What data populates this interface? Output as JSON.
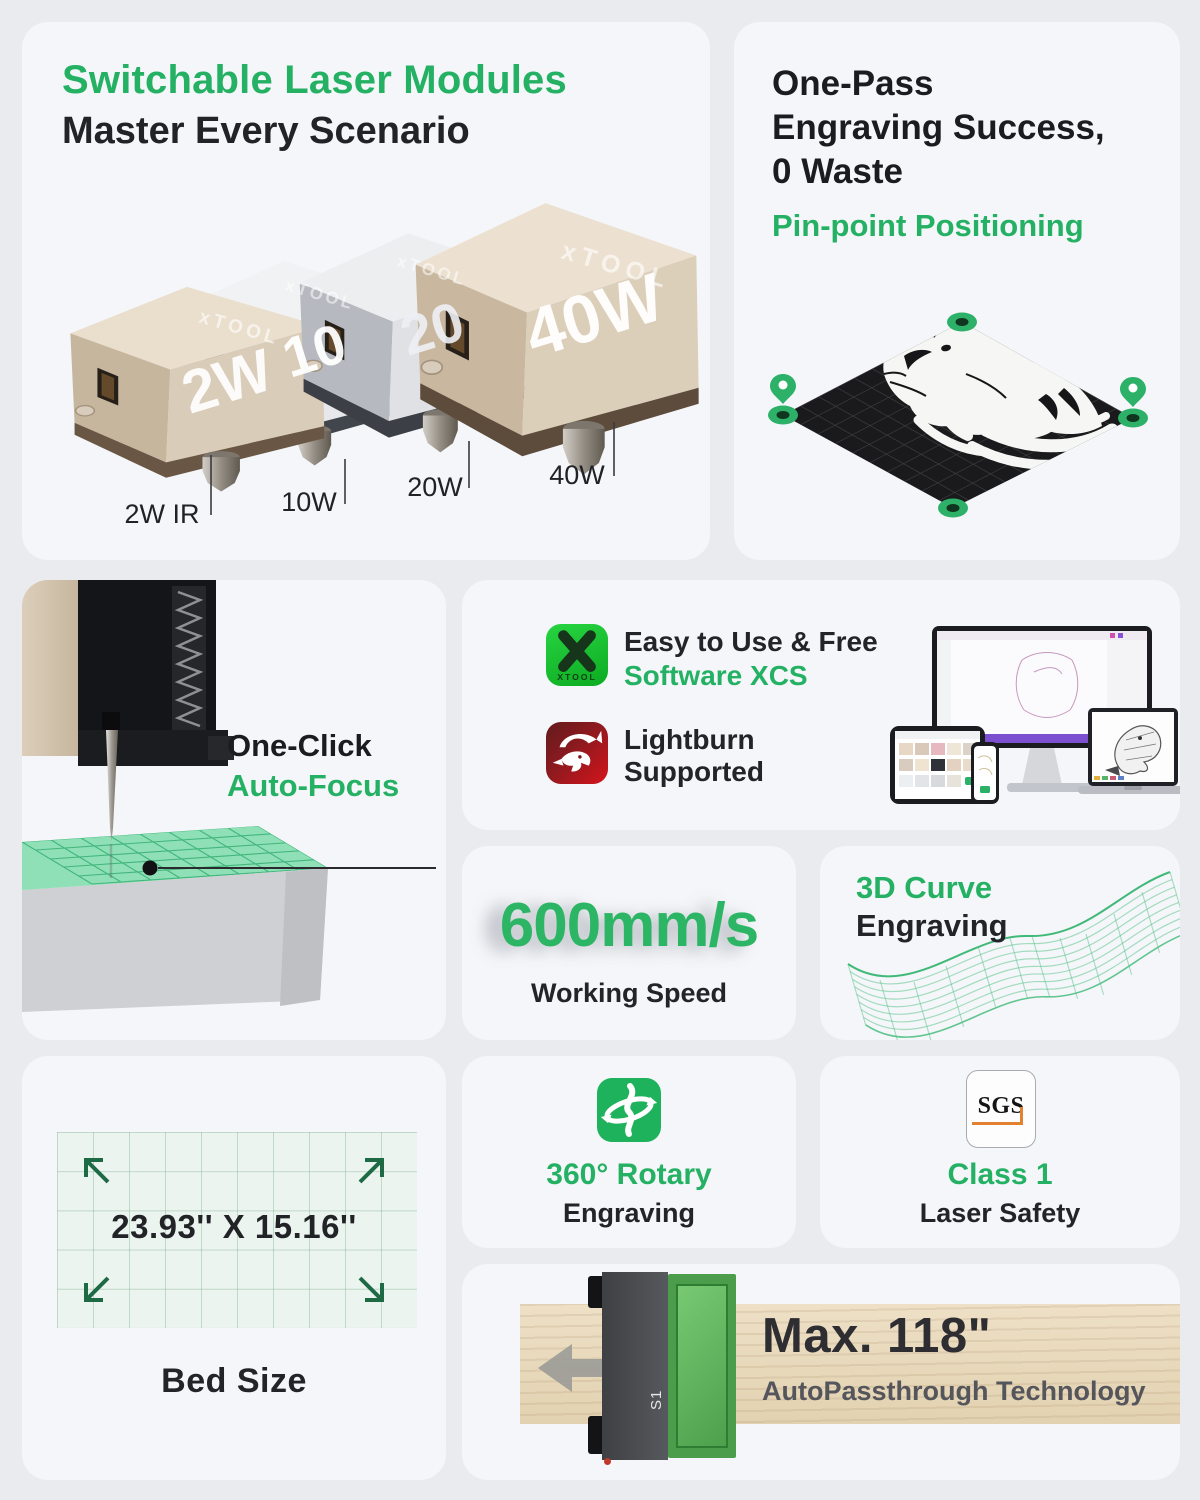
{
  "colors": {
    "page_bg": "#e9ebee",
    "card_bg": "#f4f6f9",
    "accent_green": "#25b164",
    "dark_text": "#1b1c20",
    "xcs_icon_green": "#16c12e",
    "lightburn_red": "#a5161f",
    "machine_green": "#4c9d4b",
    "wood": "#e2d2b1",
    "bed_grid_green": "#ebf4ee",
    "sgs_orange": "#e2812f"
  },
  "brand": "xTOOL",
  "cards": {
    "modules": {
      "title": "Switchable Laser Modules",
      "subtitle": "Master Every Scenario",
      "face_labels": [
        "2W",
        "10",
        "20",
        "40W"
      ],
      "callout_labels": [
        "2W IR",
        "10W",
        "20W",
        "40W"
      ]
    },
    "one_pass": {
      "title_line1": "One-Pass",
      "title_line2": "Engraving Success,",
      "title_line3": "0 Waste",
      "subtitle": "Pin-point Positioning"
    },
    "auto_focus": {
      "line1": "One-Click",
      "line2": "Auto-Focus"
    },
    "software": {
      "xcs_title": "Easy to Use & Free",
      "xcs_subtitle": "Software XCS",
      "xcs_icon_text": "XTOOL",
      "lightburn_line1": "Lightburn",
      "lightburn_line2": "Supported"
    },
    "speed": {
      "value": "600mm/s",
      "label": "Working Speed"
    },
    "curve": {
      "line1": "3D Curve",
      "line2": "Engraving"
    },
    "bed": {
      "dimensions": "23.93'' X 15.16''",
      "label": "Bed Size"
    },
    "rotary": {
      "line1": "360° Rotary",
      "line2": "Engraving"
    },
    "safety": {
      "badge": "SGS",
      "line1": "Class 1",
      "line2": "Laser Safety"
    },
    "passthrough": {
      "value": "Max. 118\"",
      "label": "AutoPassthrough Technology",
      "machine_label": "S1"
    }
  }
}
